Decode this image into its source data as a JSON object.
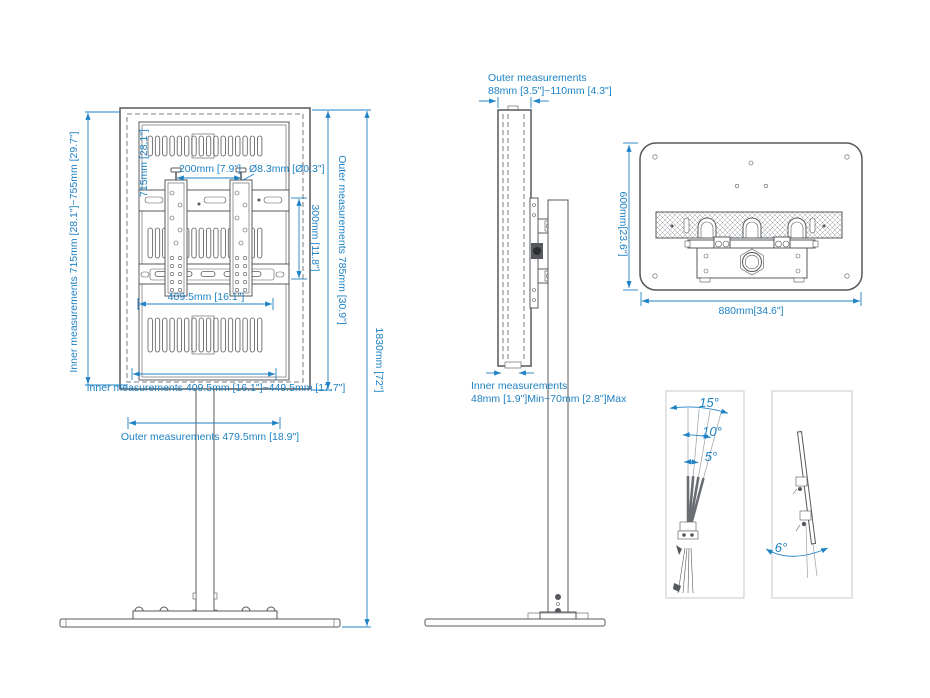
{
  "colors": {
    "dimension_blue": "#1e82c4",
    "drawing_gray": "#55585c",
    "box_border_gray": "#c8c8c8",
    "background": "#ffffff"
  },
  "front_view": {
    "labels": {
      "inner_height": "Inner measurements 715mm [28.1\"]~755mm [29.7\"]",
      "bracket_height": "715mm [28.1\"]",
      "hole_spacing": "200mm [7.9\"]",
      "hole_diameter": "Ø8.3mm [Ø0.3\"]",
      "vesa_height": "300mm [11.8\"]",
      "bracket_width": "409.5mm [16.1\"]",
      "outer_height": "Outer measurements 785mm [30.9\"]",
      "total_height": "1830mm [72\"]",
      "inner_width": "Inner measurements 409.5mm [16.1\"]~449.5mm [17.7\"]",
      "outer_width": "Outer measurements 479.5mm [18.9\"]"
    }
  },
  "side_view": {
    "labels": {
      "outer_title": "Outer measurements",
      "outer_range": "88mm [3.5\"]~110mm [4.3\"]",
      "inner_title": "Inner measurements",
      "inner_range": "48mm [1.9\"]Min~70mm [2.8\"]Max"
    }
  },
  "back_view": {
    "labels": {
      "height": "600mm[23.6\"]",
      "width": "880mm[34.6\"]"
    }
  },
  "tilt": {
    "labels": {
      "tilt_15": "15°",
      "tilt_10": "10°",
      "tilt_5": "5°",
      "tilt_6": "6°"
    }
  }
}
